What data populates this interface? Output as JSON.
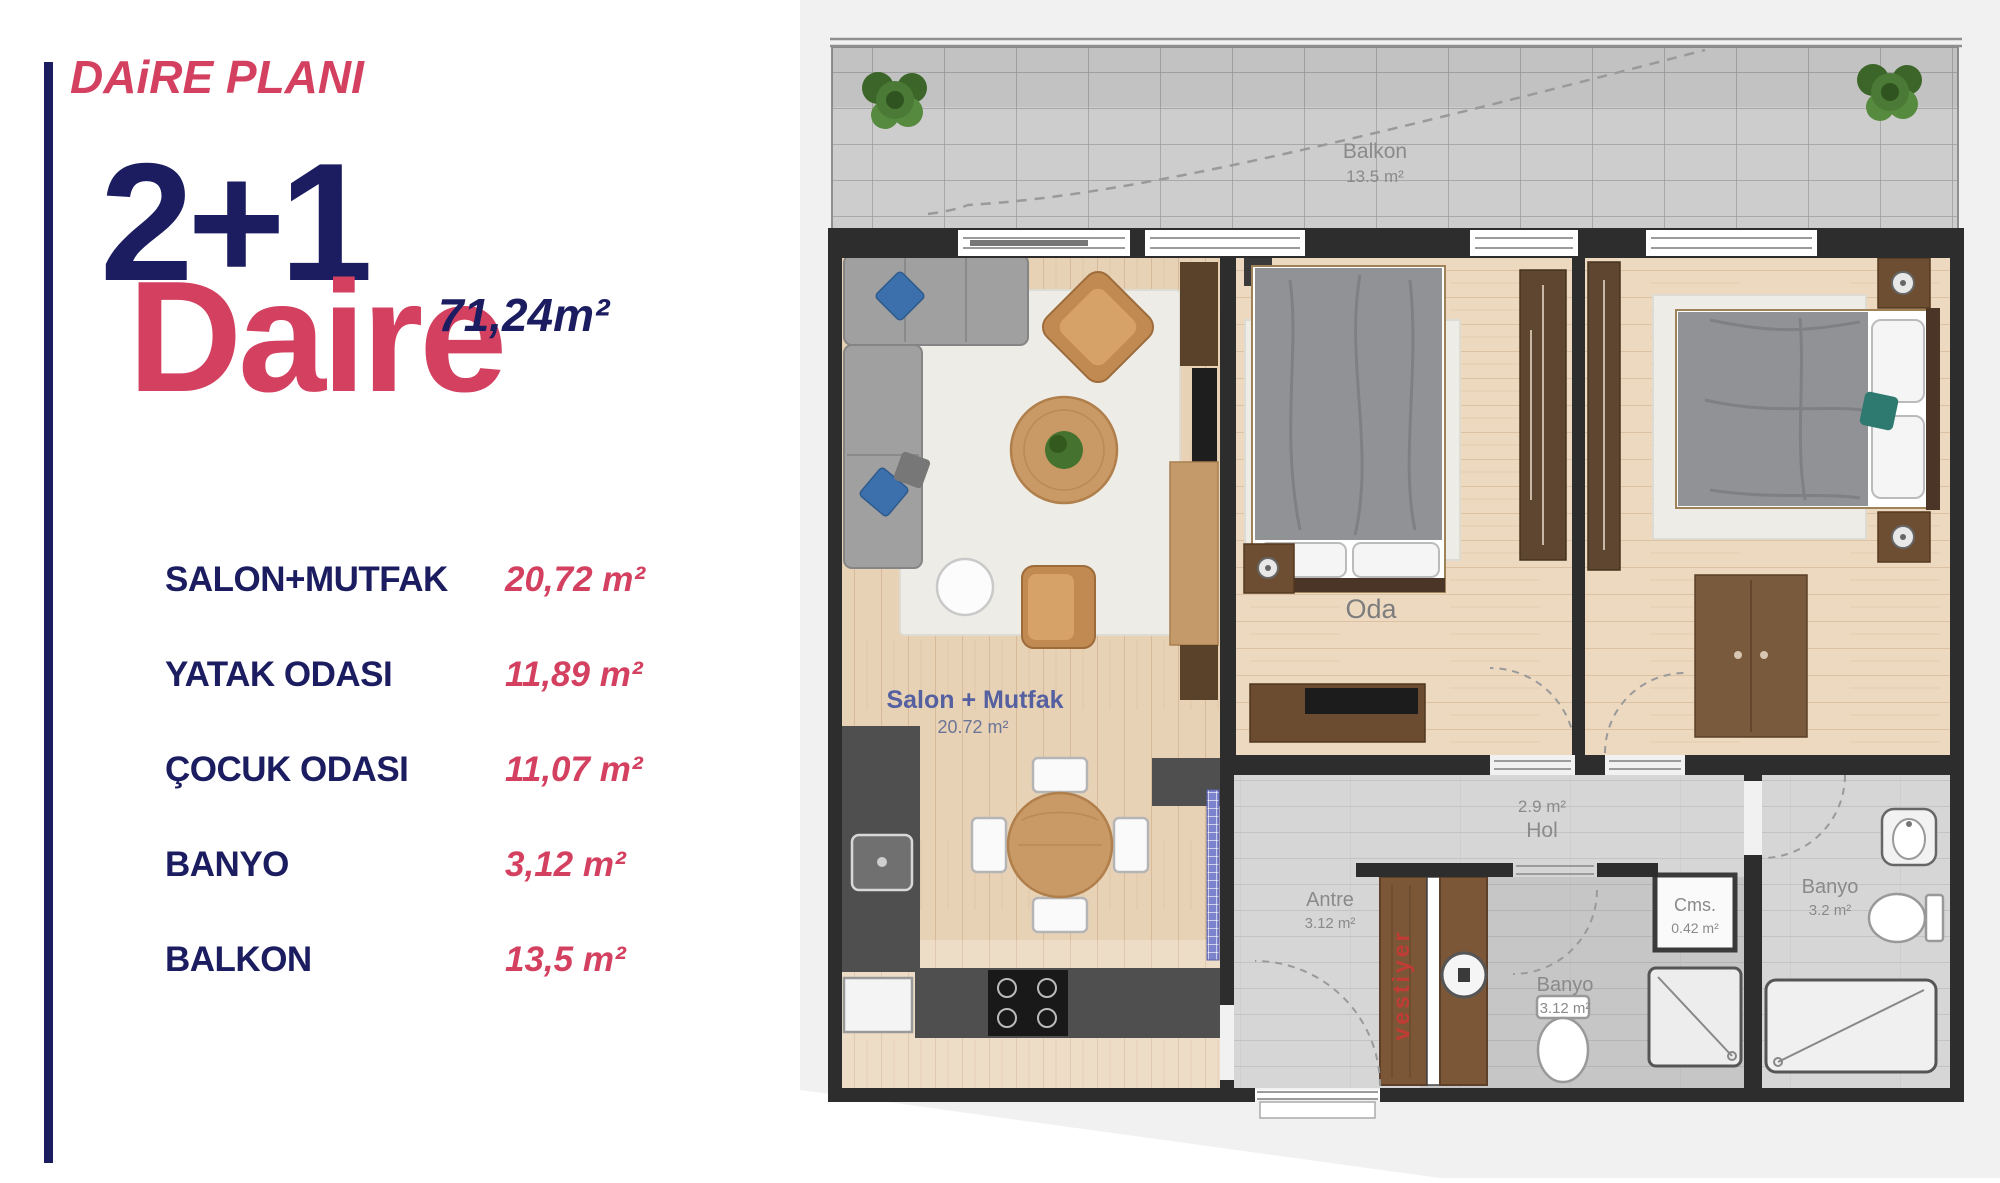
{
  "colors": {
    "navy": "#1b1d60",
    "red": "#d44160",
    "wall": "#2d2d2d",
    "plan_label_gray": "#8a8a8a",
    "plan_blue": "#5560a0",
    "vestiyer_red": "#c23b34",
    "blue_pillow": "#3c70ad",
    "teal_pillow": "#2f7a70"
  },
  "panel": {
    "title": "DAiRE PLANI",
    "unit_type": "2+1",
    "unit_name": "Daire",
    "total_area": "71,24m²",
    "rooms": [
      {
        "label": "SALON+MUTFAK",
        "area": "20,72 m²"
      },
      {
        "label": "YATAK ODASI",
        "area": "11,89 m²"
      },
      {
        "label": "ÇOCUK ODASI",
        "area": "11,07 m²"
      },
      {
        "label": "BANYO",
        "area": "3,12 m²"
      },
      {
        "label": "BALKON",
        "area": "13,5 m²"
      }
    ]
  },
  "plan": {
    "balcony_name": "Balkon",
    "balcony_area": "13.5 m²",
    "living_name": "Salon + Mutfak",
    "living_area": "20.72 m²",
    "bedroom_name": "Oda",
    "hall_area": "2.9 m²",
    "hall_name": "Hol",
    "entry_name": "Antre",
    "entry_area": "3.12 m²",
    "wardrobe_label": "vestiyer",
    "bath1_name": "Banyo",
    "bath1_area": "3.12 m²",
    "closet_name": "Cms.",
    "closet_area": "0.42 m²",
    "bath2_name": "Banyo",
    "bath2_area": "3.2 m²"
  }
}
